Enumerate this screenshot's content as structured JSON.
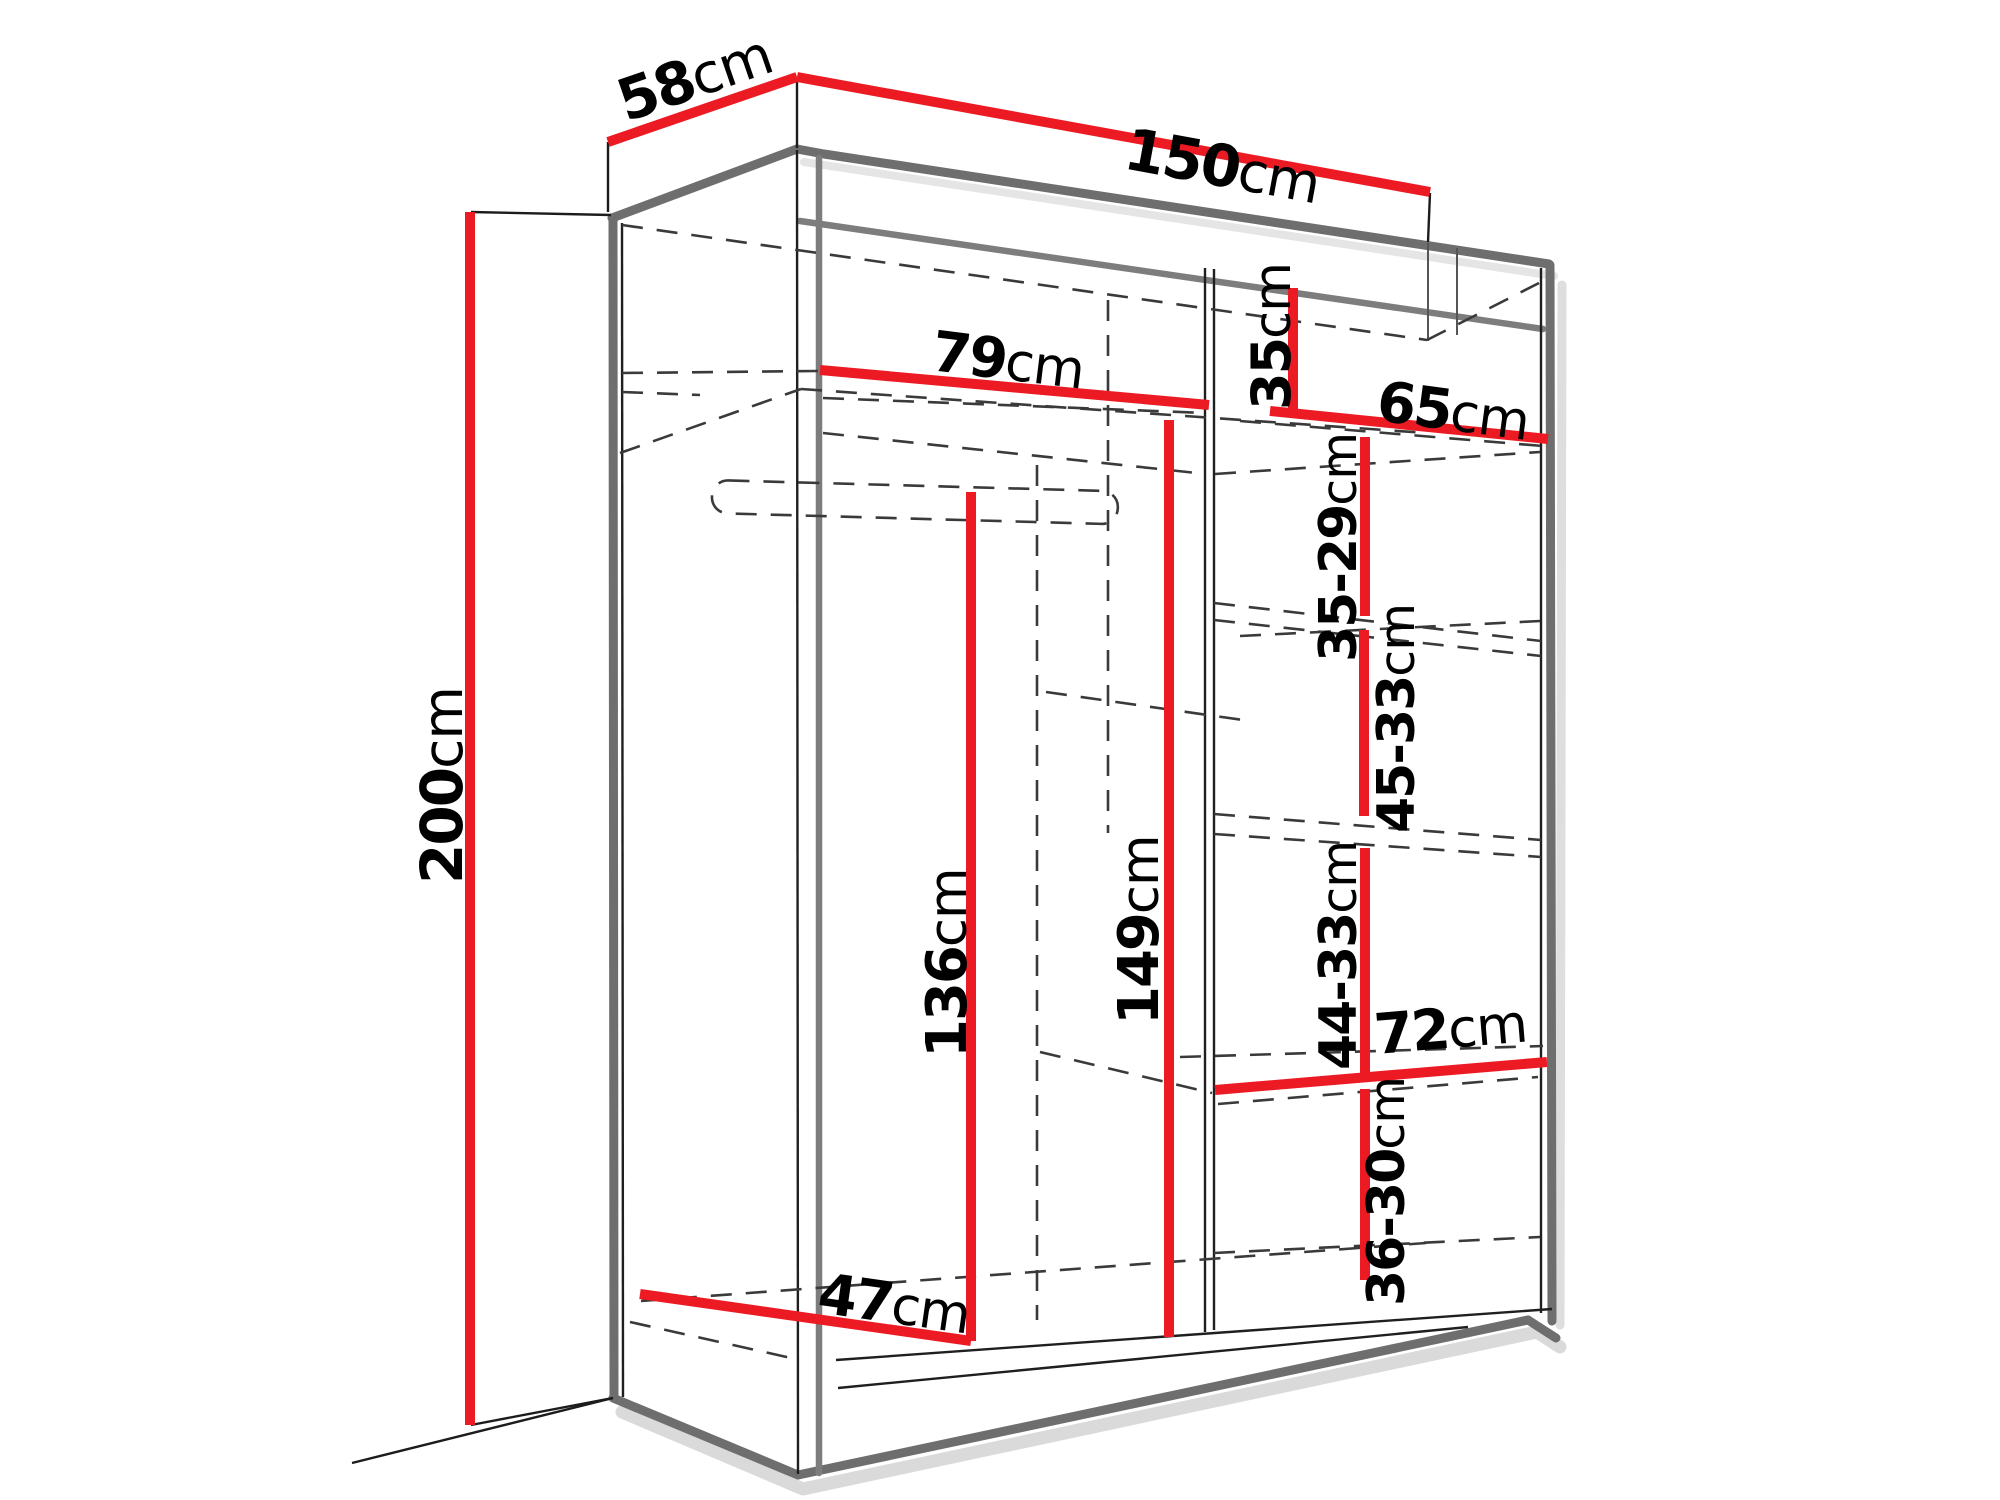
{
  "diagram": {
    "kind": "furniture-dimension-diagram",
    "subject": "wardrobe with open front showing interior shelf and rail dimensions",
    "unit": "cm",
    "colors": {
      "dimension_line": "#ec1b23",
      "cabinet_edge": "#6e6e6e",
      "hidden_line": "#3a3a3a",
      "text": "#000000",
      "background": "#ffffff"
    },
    "overall": {
      "width": "150cm",
      "depth": "58cm",
      "height": "200cm"
    },
    "labels": [
      {
        "id": "depth-top",
        "value": "58",
        "unit": "cm",
        "x": 626,
        "y": 122,
        "rotate": -19,
        "size": 58
      },
      {
        "id": "width-top",
        "value": "150",
        "unit": "cm",
        "x": 1122,
        "y": 168,
        "rotate": 10.4,
        "size": 58
      },
      {
        "id": "height-left",
        "value": "200",
        "unit": "cm",
        "x": 462,
        "y": 884,
        "rotate": -90,
        "size": 58
      },
      {
        "id": "left-section-width",
        "value": "79",
        "unit": "cm",
        "x": 930,
        "y": 370,
        "rotate": 7,
        "size": 56
      },
      {
        "id": "right-top-shelf-height",
        "value": "35",
        "unit": "cm",
        "x": 1290,
        "y": 410,
        "rotate": -90,
        "size": 54
      },
      {
        "id": "right-section-width",
        "value": "65",
        "unit": "cm",
        "x": 1375,
        "y": 420,
        "rotate": 7.5,
        "size": 56
      },
      {
        "id": "shelf-gap-1",
        "value": "35-29",
        "unit": "cm",
        "x": 1356,
        "y": 662,
        "rotate": -90,
        "size": 52
      },
      {
        "id": "shelf-gap-2",
        "value": "45-33",
        "unit": "cm",
        "x": 1414,
        "y": 833,
        "rotate": -90,
        "size": 52
      },
      {
        "id": "left-hanging-height",
        "value": "136",
        "unit": "cm",
        "x": 966,
        "y": 1058,
        "rotate": -90,
        "size": 56
      },
      {
        "id": "center-height",
        "value": "149",
        "unit": "cm",
        "x": 1158,
        "y": 1025,
        "rotate": -90,
        "size": 56
      },
      {
        "id": "shelf-gap-3",
        "value": "44-33",
        "unit": "cm",
        "x": 1356,
        "y": 1070,
        "rotate": -90,
        "size": 52
      },
      {
        "id": "bottom-right-width",
        "value": "72",
        "unit": "cm",
        "x": 1376,
        "y": 1054,
        "rotate": -4.8,
        "size": 56
      },
      {
        "id": "shelf-gap-4",
        "value": "36-30",
        "unit": "cm",
        "x": 1404,
        "y": 1306,
        "rotate": -90,
        "size": 52
      },
      {
        "id": "interior-depth",
        "value": "47",
        "unit": "cm",
        "x": 816,
        "y": 1312,
        "rotate": 8.1,
        "size": 56
      }
    ],
    "measurements_summary": {
      "width_cm": "150",
      "depth_cm": "58",
      "height_cm": "200",
      "left_compartment_width_cm": "79",
      "right_compartment_width_cm": "65",
      "right_top_compartment_height_cm": "35",
      "right_shelf_spacings_cm": [
        "35-29",
        "45-33",
        "44-33",
        "36-30"
      ],
      "left_hanging_clearance_cm": "136",
      "center_interior_height_cm": "149",
      "bottom_right_compartment_width_cm": "72",
      "interior_floor_depth_cm": "47"
    }
  }
}
